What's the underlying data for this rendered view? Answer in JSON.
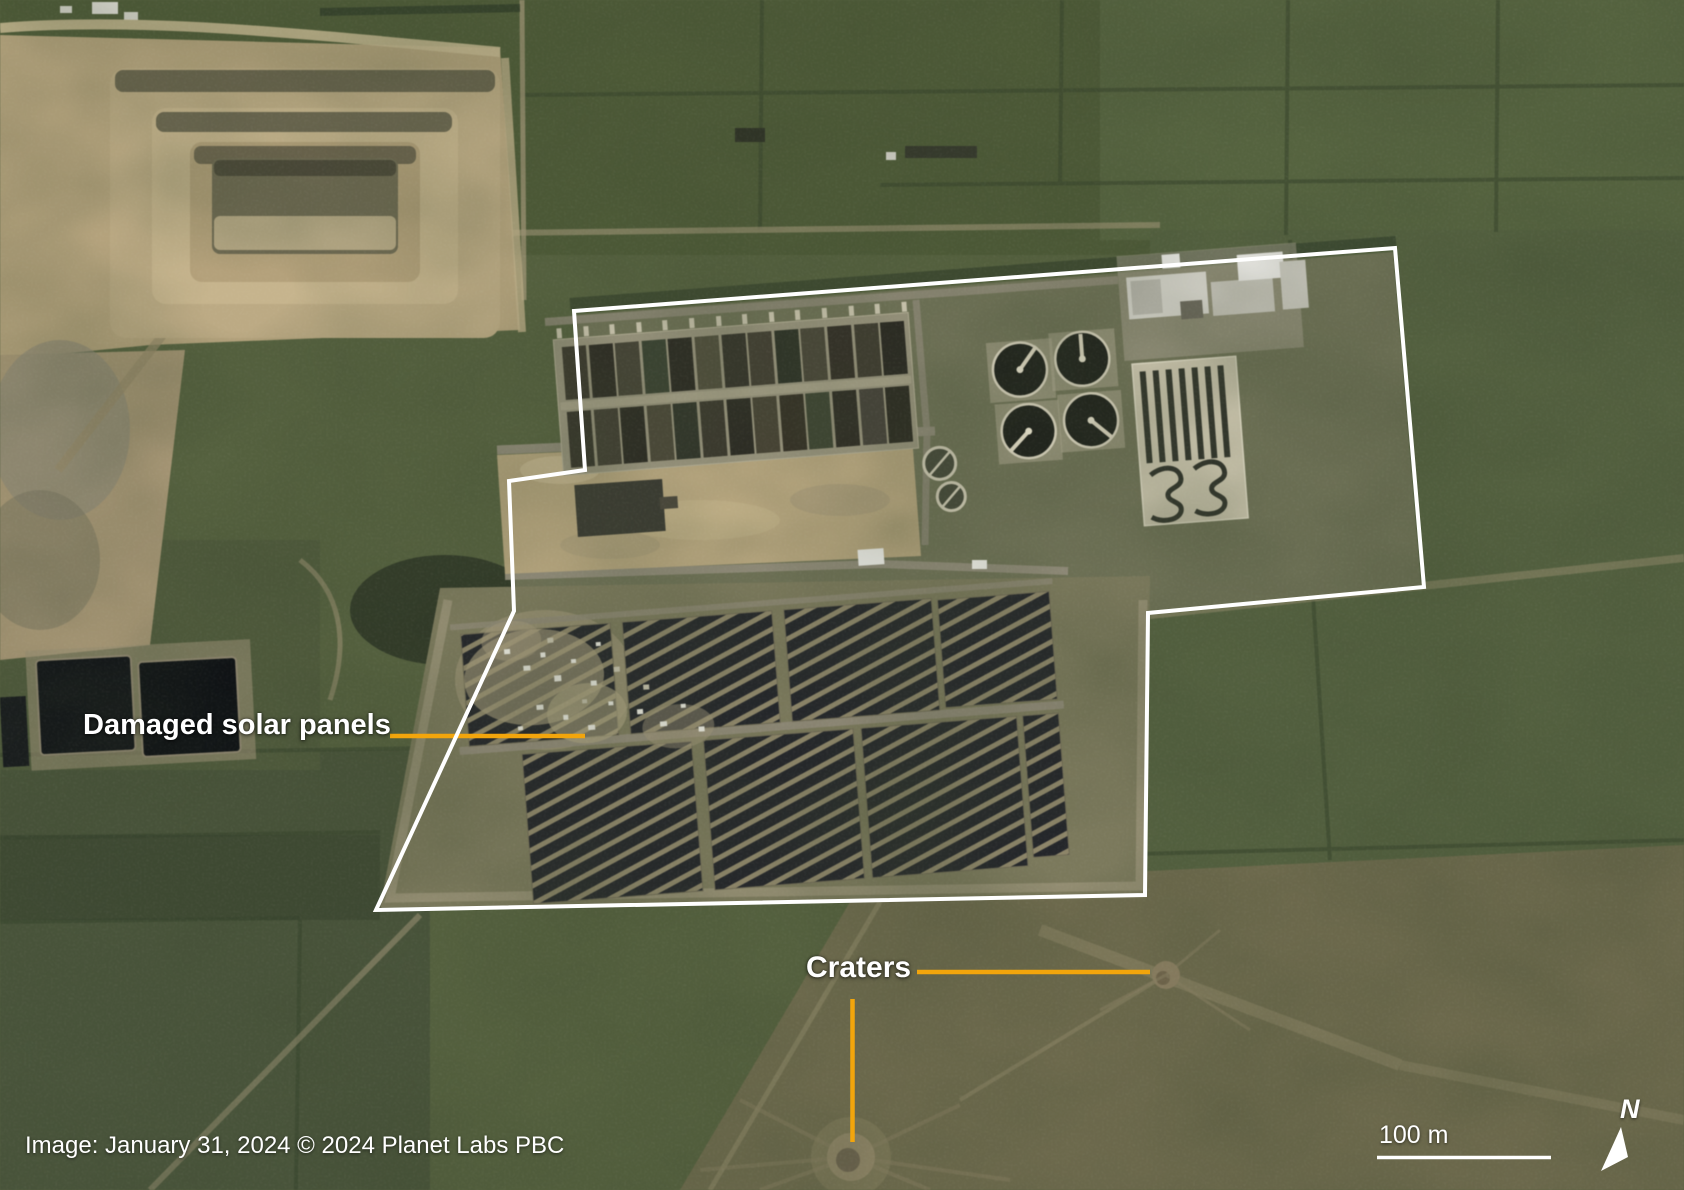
{
  "map": {
    "labels": {
      "damaged_solar_panels": "Damaged solar panels",
      "craters": "Craters"
    },
    "attribution": "Image: January 31, 2024 © 2024 Planet Labs PBC",
    "scale_bar": {
      "label": "100 m"
    },
    "compass": {
      "label": "N"
    },
    "colors": {
      "annotation_line": "#F2A50C",
      "outline_white": "#FFFFFF",
      "label_text": "#FFFFFF"
    }
  }
}
